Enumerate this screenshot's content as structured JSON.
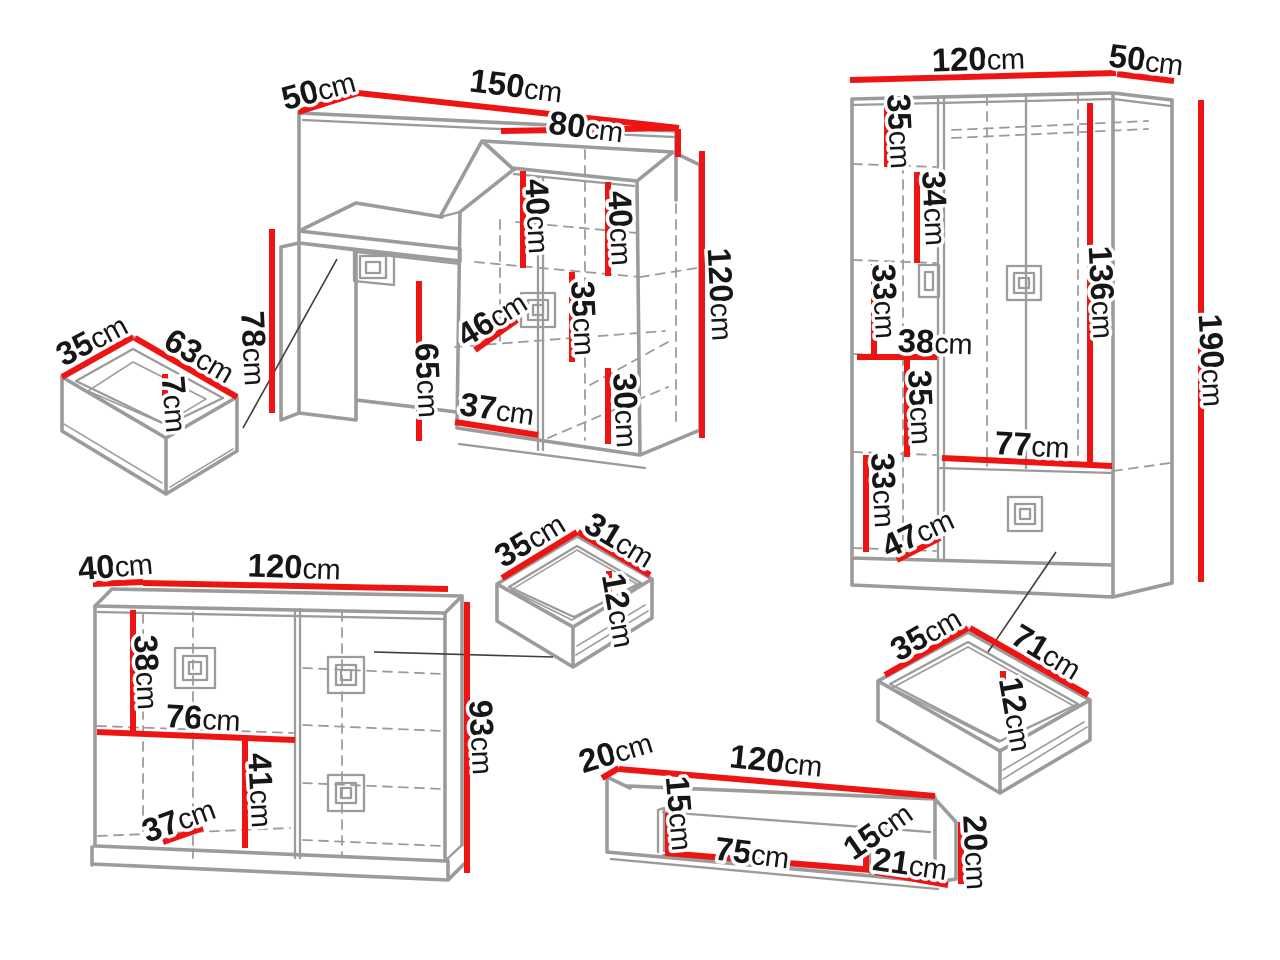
{
  "diagram": {
    "unit": "cm",
    "colors": {
      "dimension": "#ee1414",
      "outline": "#9b9b9b",
      "text": "#161616",
      "leader": "#3d3d3d",
      "background": "#ffffff"
    },
    "figures": [
      {
        "id": "dressing-table",
        "dimensions": [
          {
            "value": "50",
            "unit": "cm",
            "x": 318,
            "y": 89,
            "rot": -15,
            "line": [
              298,
              112,
              358,
              93
            ]
          },
          {
            "value": "150",
            "unit": "cm",
            "x": 516,
            "y": 85,
            "rot": 7,
            "line": [
              358,
              93,
              679,
              128
            ]
          },
          {
            "value": "80",
            "unit": "cm",
            "x": 586,
            "y": 126,
            "rot": 7,
            "line": [
              501,
              131,
              677,
              128
            ]
          },
          {
            "value": "40",
            "unit": "cm",
            "x": 539,
            "y": 216,
            "rot": 87,
            "line": [
              523,
              171,
              523,
              268
            ]
          },
          {
            "value": "40",
            "unit": "cm",
            "x": 622,
            "y": 228,
            "rot": 87,
            "line": [
              608,
              182,
              608,
              276
            ]
          },
          {
            "value": "120",
            "unit": "cm",
            "x": 722,
            "y": 294,
            "rot": 87,
            "line": [
              702,
              151,
              702,
              438
            ]
          },
          {
            "value": "78",
            "unit": "cm",
            "x": 255,
            "y": 348,
            "rot": 87,
            "line": [
              272,
              229,
              272,
              413
            ]
          },
          {
            "value": "65",
            "unit": "cm",
            "x": 429,
            "y": 380,
            "rot": 87,
            "line": [
              419,
              281,
              419,
              441
            ]
          },
          {
            "value": "46",
            "unit": "cm",
            "x": 491,
            "y": 318,
            "rot": -32,
            "line": [
              475,
              350,
              517,
              320
            ]
          },
          {
            "value": "35",
            "unit": "cm",
            "x": 585,
            "y": 318,
            "rot": 87,
            "line": [
              572,
              272,
              572,
              362
            ]
          },
          {
            "value": "30",
            "unit": "cm",
            "x": 627,
            "y": 410,
            "rot": 87,
            "line": [
              608,
              368,
              608,
              444
            ]
          },
          {
            "value": "37",
            "unit": "cm",
            "x": 497,
            "y": 408,
            "rot": 8,
            "line": [
              455,
              422,
              538,
              435
            ]
          }
        ],
        "tick_lines": [
          [
            678,
            129,
            678,
            157
          ]
        ]
      },
      {
        "id": "drawer-left",
        "dimensions": [
          {
            "value": "35",
            "unit": "cm",
            "x": 91,
            "y": 339,
            "rot": -28,
            "line": [
              62,
              377,
              133,
              337
            ]
          },
          {
            "value": "63",
            "unit": "cm",
            "x": 200,
            "y": 355,
            "rot": 30,
            "line": [
              135,
              338,
              237,
              397
            ]
          },
          {
            "value": "7",
            "unit": "cm",
            "x": 176,
            "y": 404,
            "rot": 85,
            "line": [
              165,
              374,
              165,
              398
            ]
          }
        ]
      },
      {
        "id": "wardrobe",
        "dimensions": [
          {
            "value": "120",
            "unit": "cm",
            "x": 978,
            "y": 58,
            "rot": -2,
            "line": [
              850,
              80,
              1116,
              73
            ]
          },
          {
            "value": "50",
            "unit": "cm",
            "x": 1146,
            "y": 59,
            "rot": 7,
            "line": [
              1117,
              74,
              1174,
              81
            ]
          },
          {
            "value": "35",
            "unit": "cm",
            "x": 901,
            "y": 131,
            "rot": 87,
            "line": [
              887,
              107,
              887,
              167
            ]
          },
          {
            "value": "34",
            "unit": "cm",
            "x": 936,
            "y": 208,
            "rot": 87,
            "line": [
              917,
              172,
              917,
              263
            ]
          },
          {
            "value": "33",
            "unit": "cm",
            "x": 886,
            "y": 301,
            "rot": 87,
            "line": [
              874,
              264,
              874,
              357
            ]
          },
          {
            "value": "38",
            "unit": "cm",
            "x": 935,
            "y": 341,
            "rot": 2,
            "line": [
              857,
              357,
              937,
              357
            ]
          },
          {
            "value": "35",
            "unit": "cm",
            "x": 922,
            "y": 407,
            "rot": 87,
            "line": [
              907,
              360,
              907,
              457
            ]
          },
          {
            "value": "33",
            "unit": "cm",
            "x": 885,
            "y": 490,
            "rot": 87,
            "line": [
              866,
              455,
              866,
              552
            ]
          },
          {
            "value": "47",
            "unit": "cm",
            "x": 917,
            "y": 532,
            "rot": -25,
            "line": [
              897,
              560,
              940,
              538
            ]
          },
          {
            "value": "77",
            "unit": "cm",
            "x": 1032,
            "y": 444,
            "rot": 3,
            "line": [
              942,
              458,
              1112,
              466
            ]
          },
          {
            "value": "136",
            "unit": "cm",
            "x": 1103,
            "y": 292,
            "rot": 87,
            "line": [
              1090,
              103,
              1090,
              467
            ]
          },
          {
            "value": "190",
            "unit": "cm",
            "x": 1213,
            "y": 360,
            "rot": 87,
            "line": [
              1201,
              100,
              1201,
              582
            ]
          }
        ]
      },
      {
        "id": "chest-of-drawers",
        "dimensions": [
          {
            "value": "40",
            "unit": "cm",
            "x": 115,
            "y": 565,
            "rot": -5,
            "line": [
              93,
              584,
              143,
              582
            ]
          },
          {
            "value": "120",
            "unit": "cm",
            "x": 294,
            "y": 566,
            "rot": 2,
            "line": [
              143,
              583,
              448,
              589
            ]
          },
          {
            "value": "38",
            "unit": "cm",
            "x": 148,
            "y": 672,
            "rot": 87,
            "line": [
              133,
              610,
              133,
              733
            ]
          },
          {
            "value": "76",
            "unit": "cm",
            "x": 203,
            "y": 717,
            "rot": 3,
            "line": [
              97,
              732,
              295,
              740
            ]
          },
          {
            "value": "41",
            "unit": "cm",
            "x": 262,
            "y": 790,
            "rot": 87,
            "line": [
              245,
              738,
              245,
              848
            ]
          },
          {
            "value": "37",
            "unit": "cm",
            "x": 178,
            "y": 819,
            "rot": -20,
            "line": [
              163,
              842,
              203,
              828
            ]
          },
          {
            "value": "93",
            "unit": "cm",
            "x": 483,
            "y": 737,
            "rot": 87,
            "line": [
              467,
              602,
              467,
              873
            ]
          }
        ]
      },
      {
        "id": "drawer-middle",
        "dimensions": [
          {
            "value": "35",
            "unit": "cm",
            "x": 529,
            "y": 539,
            "rot": -31,
            "line": [
              502,
              578,
              577,
              532
            ]
          },
          {
            "value": "31",
            "unit": "cm",
            "x": 620,
            "y": 539,
            "rot": 31,
            "line": [
              578,
              532,
              650,
              575
            ]
          },
          {
            "value": "12",
            "unit": "cm",
            "x": 620,
            "y": 610,
            "rot": 80,
            "line": [
              609,
              571,
              609,
              593
            ]
          }
        ]
      },
      {
        "id": "drawer-right",
        "dimensions": [
          {
            "value": "35",
            "unit": "cm",
            "x": 925,
            "y": 633,
            "rot": -30,
            "line": [
              885,
              675,
              968,
              628
            ]
          },
          {
            "value": "71",
            "unit": "cm",
            "x": 1047,
            "y": 651,
            "rot": 31,
            "line": [
              970,
              628,
              1088,
              695
            ]
          },
          {
            "value": "12",
            "unit": "cm",
            "x": 1017,
            "y": 714,
            "rot": 80,
            "line": [
              1003,
              671,
              1003,
              697
            ]
          }
        ]
      },
      {
        "id": "wall-shelf",
        "dimensions": [
          {
            "value": "20",
            "unit": "cm",
            "x": 615,
            "y": 751,
            "rot": -17,
            "line": [
              602,
              778,
              619,
              768
            ]
          },
          {
            "value": "120",
            "unit": "cm",
            "x": 776,
            "y": 760,
            "rot": 6,
            "line": [
              619,
              769,
              935,
              796
            ]
          },
          {
            "value": "15",
            "unit": "cm",
            "x": 681,
            "y": 813,
            "rot": 85,
            "line": [
              668,
              813,
              668,
              852
            ]
          },
          {
            "value": "75",
            "unit": "cm",
            "x": 752,
            "y": 852,
            "rot": 7,
            "line": [
              665,
              853,
              887,
              871
            ]
          },
          {
            "value": "15",
            "unit": "cm",
            "x": 877,
            "y": 830,
            "rot": -35,
            "line": [
              866,
              840,
              866,
              872
            ]
          },
          {
            "value": "21",
            "unit": "cm",
            "x": 910,
            "y": 863,
            "rot": 8,
            "line": [
              875,
              872,
              948,
              885
            ]
          },
          {
            "value": "20",
            "unit": "cm",
            "x": 977,
            "y": 852,
            "rot": 87,
            "line": [
              961,
              822,
              961,
              884
            ]
          }
        ]
      }
    ]
  }
}
